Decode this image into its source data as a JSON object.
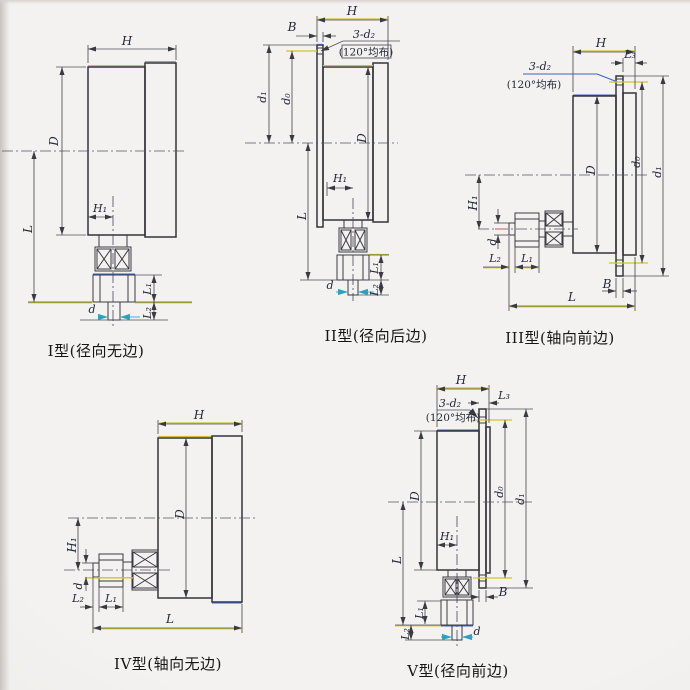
{
  "sheet_title": "压力表安装型式图",
  "palette": {
    "line": "#33343a",
    "dimension": "#4c4d55",
    "centerline": "#50516a",
    "accent_yellow": "#d2c22c",
    "accent_blue": "#3c62c4",
    "accent_cyan": "#3fb3d6",
    "label_text": "#20283a",
    "caption_text": "#161616",
    "paper": "#f4f2f0"
  },
  "figures": [
    {
      "caption": "I型(径向无边)",
      "labels": {
        "H": "H",
        "D": "D",
        "L": "L",
        "H1": "H₁",
        "L1": "L₁",
        "L2": "L₂",
        "d": "d"
      }
    },
    {
      "caption": "II型(径向后边)",
      "labels": {
        "H": "H",
        "B": "B",
        "holes": "3-d₂",
        "pattern": "(120°均布)",
        "d1": "d₁",
        "d0": "d₀",
        "D": "D",
        "L": "L",
        "H1": "H₁",
        "L1": "L₁",
        "L2": "L₂",
        "d": "d"
      }
    },
    {
      "caption": "III型(轴向前边)",
      "labels": {
        "H": "H",
        "L3": "L₃",
        "holes": "3-d₂",
        "pattern": "(120°均布)",
        "d0": "d₀",
        "d1": "d₁",
        "D": "D",
        "H1": "H₁",
        "d": "d",
        "L2": "L₂",
        "L1": "L₁",
        "B": "B",
        "L": "L"
      }
    },
    {
      "caption": "IV型(轴向无边)",
      "labels": {
        "H": "H",
        "D": "D",
        "H1": "H₁",
        "d": "d",
        "L2": "L₂",
        "L1": "L₁",
        "L": "L"
      }
    },
    {
      "caption": "V型(径向前边)",
      "labels": {
        "H": "H",
        "L3": "L₃",
        "holes": "3-d₂",
        "pattern": "(120°均布)",
        "d0": "d₀",
        "d1": "d₁",
        "D": "D",
        "L": "L",
        "H1": "H₁",
        "L1": "L₁",
        "L2": "L₂",
        "d": "d",
        "B": "B"
      }
    }
  ]
}
